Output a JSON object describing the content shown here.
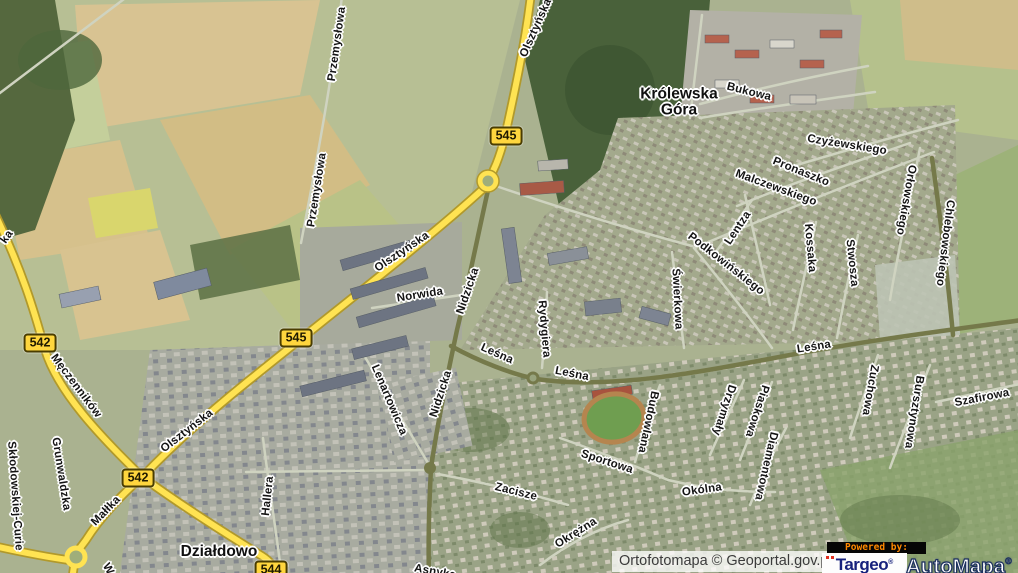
{
  "map": {
    "place_labels": [
      {
        "text": "Królewska\nGóra",
        "x": 679,
        "y": 103
      },
      {
        "text": "Działdowo",
        "x": 219,
        "y": 552
      }
    ],
    "road_shields": [
      {
        "text": "545",
        "x": 506,
        "y": 136
      },
      {
        "text": "545",
        "x": 296,
        "y": 338
      },
      {
        "text": "542",
        "x": 40,
        "y": 343
      },
      {
        "text": "542",
        "x": 138,
        "y": 478
      },
      {
        "text": "544",
        "x": 271,
        "y": 570
      }
    ],
    "street_labels": [
      {
        "text": "Przemysłowa",
        "x": 337,
        "y": 44,
        "r": -82
      },
      {
        "text": "Przemysłowa",
        "x": 317,
        "y": 190,
        "r": -81
      },
      {
        "text": "Olsztyńska",
        "x": 536,
        "y": 28,
        "r": -66
      },
      {
        "text": "Olsztyńska",
        "x": 402,
        "y": 252,
        "r": -34
      },
      {
        "text": "Olsztyńska",
        "x": 187,
        "y": 431,
        "r": -38
      },
      {
        "text": "Norwida",
        "x": 420,
        "y": 295,
        "r": -9
      },
      {
        "text": "Nidzicka",
        "x": 468,
        "y": 291,
        "r": -71
      },
      {
        "text": "Nidzicka",
        "x": 441,
        "y": 394,
        "r": -72
      },
      {
        "text": "Lenartowicza",
        "x": 389,
        "y": 400,
        "r": 67
      },
      {
        "text": "Leśna",
        "x": 497,
        "y": 354,
        "r": 24
      },
      {
        "text": "Leśna",
        "x": 572,
        "y": 374,
        "r": 11
      },
      {
        "text": "Leśna",
        "x": 814,
        "y": 347,
        "r": -9
      },
      {
        "text": "Rydygiera",
        "x": 544,
        "y": 329,
        "r": 85
      },
      {
        "text": "Męczenników",
        "x": 76,
        "y": 386,
        "r": 53
      },
      {
        "text": "Grunwaldzka",
        "x": 61,
        "y": 474,
        "r": 81
      },
      {
        "text": "Skłodowskiej-Curie",
        "x": 15,
        "y": 496,
        "r": 86
      },
      {
        "text": "Małłka",
        "x": 106,
        "y": 511,
        "r": -46
      },
      {
        "text": "Hallera",
        "x": 268,
        "y": 496,
        "r": -84
      },
      {
        "text": "Bukowa",
        "x": 749,
        "y": 92,
        "r": 14
      },
      {
        "text": "Czyżewskiego",
        "x": 847,
        "y": 145,
        "r": 9
      },
      {
        "text": "Pronaszko",
        "x": 801,
        "y": 172,
        "r": 22
      },
      {
        "text": "Malczewskiego",
        "x": 776,
        "y": 188,
        "r": 20
      },
      {
        "text": "Lentza",
        "x": 738,
        "y": 228,
        "r": -56
      },
      {
        "text": "Podkowińskiego",
        "x": 726,
        "y": 264,
        "r": 38
      },
      {
        "text": "Kossaka",
        "x": 810,
        "y": 248,
        "r": 85
      },
      {
        "text": "Stwosza",
        "x": 852,
        "y": 263,
        "r": 84
      },
      {
        "text": "Orłowskiego",
        "x": 906,
        "y": 200,
        "r": 100
      },
      {
        "text": "Chlebowskiego",
        "x": 945,
        "y": 243,
        "r": 97
      },
      {
        "text": "Świerkowa",
        "x": 677,
        "y": 299,
        "r": 87
      },
      {
        "text": "Zacisze",
        "x": 516,
        "y": 492,
        "r": 14
      },
      {
        "text": "Sportowa",
        "x": 607,
        "y": 462,
        "r": 18
      },
      {
        "text": "Okólna",
        "x": 702,
        "y": 490,
        "r": -8
      },
      {
        "text": "Okrężna",
        "x": 576,
        "y": 533,
        "r": -32
      },
      {
        "text": "Budowlana",
        "x": 648,
        "y": 422,
        "r": 102
      },
      {
        "text": "Drzymały",
        "x": 724,
        "y": 410,
        "r": 108
      },
      {
        "text": "Piaskowa",
        "x": 757,
        "y": 411,
        "r": 108
      },
      {
        "text": "Diamentowa",
        "x": 766,
        "y": 466,
        "r": 103
      },
      {
        "text": "Zuchowa",
        "x": 870,
        "y": 390,
        "r": 100
      },
      {
        "text": "Bursztynowa",
        "x": 914,
        "y": 412,
        "r": 99
      },
      {
        "text": "Szafirowa",
        "x": 982,
        "y": 398,
        "r": -11
      },
      {
        "text": "Asnyka",
        "x": 435,
        "y": 572,
        "r": 10
      },
      {
        "text": "W",
        "x": 108,
        "y": 569,
        "r": 60
      },
      {
        "text": "ka",
        "x": 7,
        "y": 237,
        "r": -55
      }
    ]
  },
  "footer": {
    "attribution": "Ortofotomapa © Geoportal.gov.pl",
    "powered_by": "Powered by:",
    "targeo": "Targeo",
    "automapa": "AutoMapa",
    "reg_mark": "®"
  },
  "colors": {
    "road_primary": "#ffe352",
    "road_casing": "#b1992b",
    "road_secondary": "#75794a",
    "shield_bg": "#ffd63e",
    "label_halo": "#ffffff",
    "forest_green": "#49613a",
    "field_tan": "#d8c392",
    "targeo_blue": "#16217c",
    "powered_by_orange": "#ff8800",
    "automapa_outline": "#1b2f5e"
  }
}
